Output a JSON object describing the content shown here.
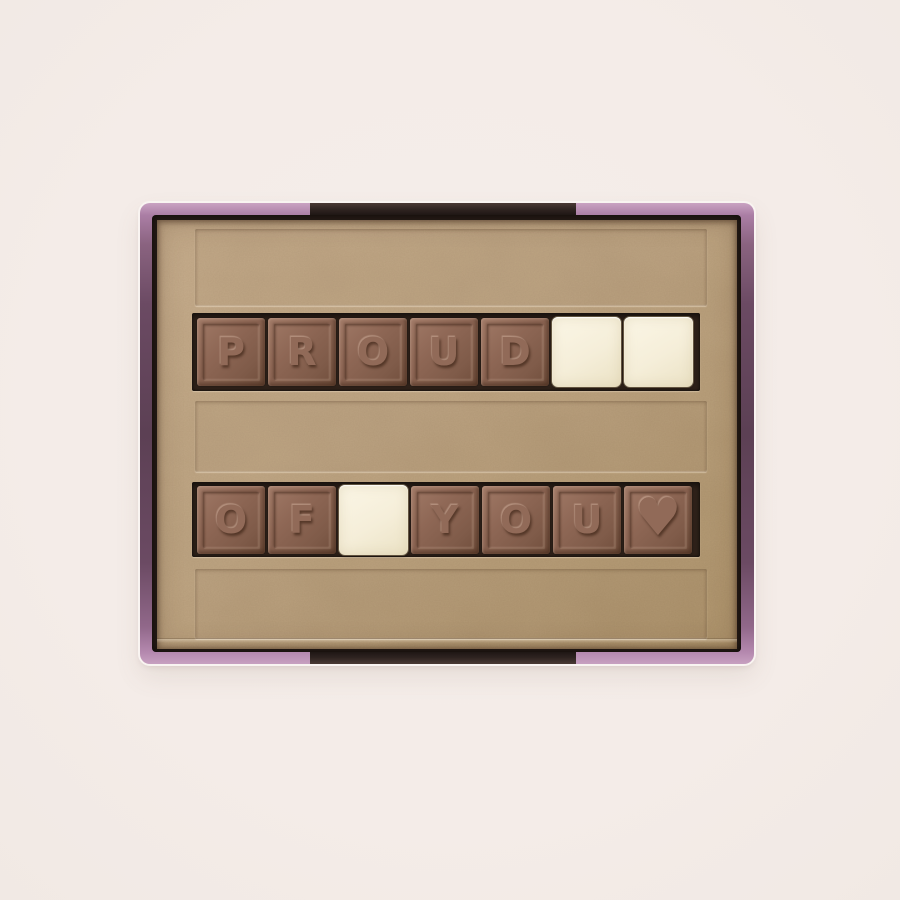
{
  "scene": {
    "name": "chocolate-message-gift-box-photo",
    "description": "Top-down product photo of an open chocolate gift box with a lilac foil rim, kraft paper liner and embossed chocolate letter tiles spelling a message",
    "background_color": "#f4ece8"
  },
  "box": {
    "rim_color_light": "#b488ae",
    "rim_color_dark": "#5c4054",
    "notch_color": "#2e2320",
    "paper_color": "#c0a785",
    "tray_slot_color": "#2f221a"
  },
  "tile_colors": {
    "milk_chocolate": "#8e6755",
    "white_chocolate": "#f5eed9"
  },
  "message": {
    "text": "PROUD OF YOU ♥",
    "rows": [
      {
        "tiles": [
          {
            "type": "milk",
            "glyph": "P"
          },
          {
            "type": "milk",
            "glyph": "R"
          },
          {
            "type": "milk",
            "glyph": "O"
          },
          {
            "type": "milk",
            "glyph": "U"
          },
          {
            "type": "milk",
            "glyph": "D"
          },
          {
            "type": "white",
            "glyph": ""
          },
          {
            "type": "white",
            "glyph": ""
          }
        ]
      },
      {
        "tiles": [
          {
            "type": "milk",
            "glyph": "O"
          },
          {
            "type": "milk",
            "glyph": "F"
          },
          {
            "type": "white",
            "glyph": ""
          },
          {
            "type": "milk",
            "glyph": "Y"
          },
          {
            "type": "milk",
            "glyph": "O"
          },
          {
            "type": "milk",
            "glyph": "U"
          },
          {
            "type": "milk",
            "glyph": "♥",
            "icon": "heart"
          }
        ]
      }
    ]
  }
}
